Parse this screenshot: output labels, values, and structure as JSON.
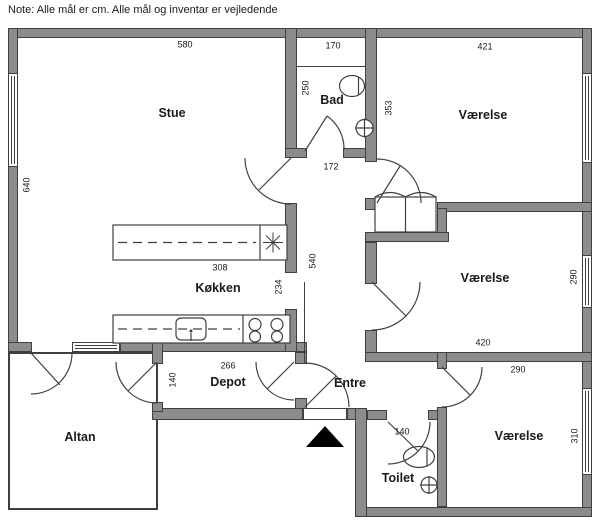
{
  "note": "Note: Alle mål er cm. Alle mål og inventar er vejledende",
  "colors": {
    "wall": "#8c8c8c",
    "line": "#404040",
    "text": "#1a1a1a"
  },
  "hall": {
    "width": "172",
    "length": "540"
  },
  "rooms": {
    "stue": {
      "label": "Stue",
      "width": "580",
      "height": "640"
    },
    "bad": {
      "label": "Bad",
      "width": "170",
      "height": "250"
    },
    "vaerelse_top": {
      "label": "Værelse",
      "width": "421",
      "height": "353"
    },
    "vaerelse_mid": {
      "label": "Værelse",
      "width": "420",
      "height": "290"
    },
    "vaerelse_btm": {
      "label": "Værelse",
      "width": "290",
      "height": "310"
    },
    "koekken": {
      "label": "Køkken",
      "counter_top": "308",
      "counter_bottom": "266",
      "depth": "234"
    },
    "depot": {
      "label": "Depot",
      "height": "140"
    },
    "entre": {
      "label": "Entre"
    },
    "toilet": {
      "label": "Toilet",
      "width": "140"
    },
    "altan": {
      "label": "Altan"
    }
  }
}
